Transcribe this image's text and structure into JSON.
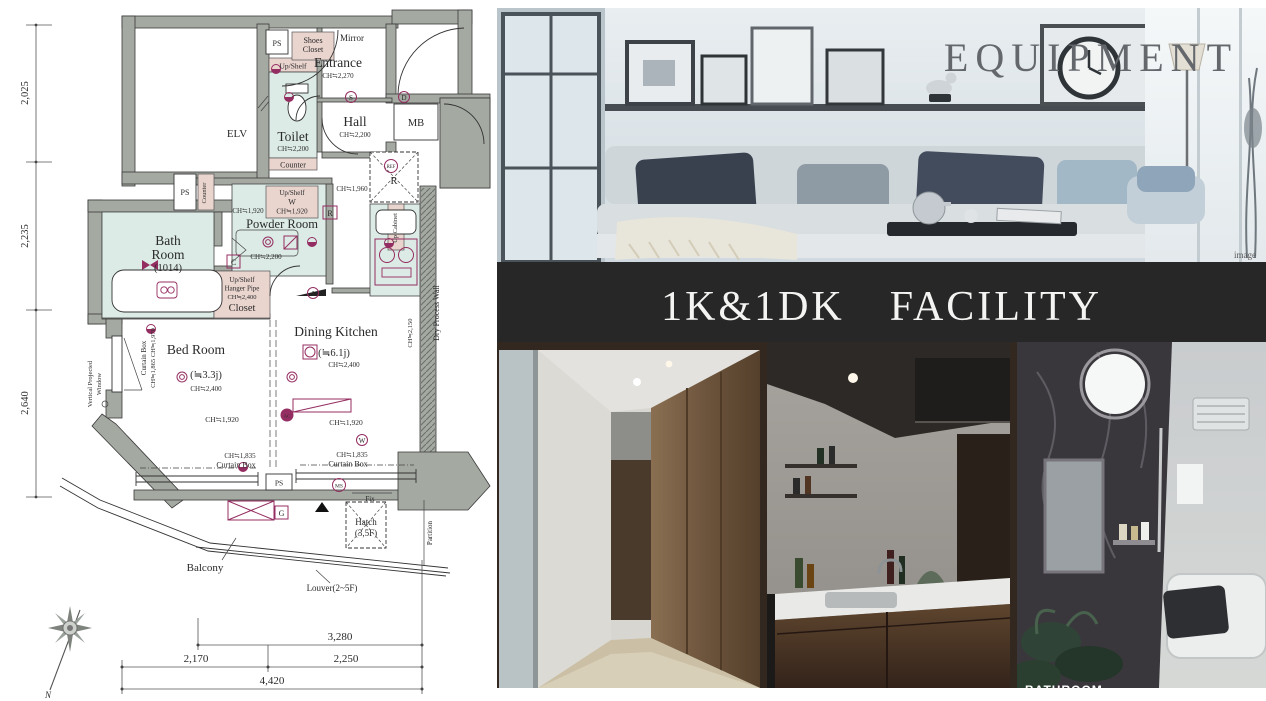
{
  "palette": {
    "banner_bg": "#272727",
    "plan_accent": "#942d61",
    "wet_room": "#dcebe5",
    "storage_pink": "#e9d4ce",
    "wall_gray": "#a4a9a2"
  },
  "hero": {
    "title": "EQUIPMENT",
    "caption": "image"
  },
  "banner": {
    "title": "1K&1DK　FACILITY"
  },
  "gallery": {
    "bathroom_caption": "BATHROOM"
  },
  "floorplan": {
    "dims": {
      "left": [
        "2,025",
        "2,235",
        "2,640"
      ],
      "b1": "3,280",
      "b2a": "2,170",
      "b2b": "2,250",
      "b3": "4,420",
      "north": "N"
    },
    "labels": {
      "elv": "ELV",
      "ps": "PS",
      "mirror": "Mirror",
      "shoes1": "Shoes",
      "shoes2": "Closet",
      "entrance": "Entrance",
      "entrance_ch": "CH≒2,270",
      "up_shelf": "Up/Shelf",
      "toilet": "Toilet",
      "ch2200": "CH≒2,200",
      "hall": "Hall",
      "mb": "MB",
      "counter": "Counter",
      "ch1960": "CH≒1,960",
      "ref": "REF",
      "r": "R",
      "up_cabinet": "Up Cabinet",
      "w": "W",
      "ch1920": "CH≒1,920",
      "powder": "Powder Room",
      "c": "C",
      "bath1": "Bath",
      "bath2": "Room",
      "bath_size": "(1014)",
      "hanger": "Hanger Pipe",
      "ch2400": "CH≒2,400",
      "closet": "Closet",
      "bed": "Bed Room",
      "bed_size": "(≒3.3j)",
      "curtain": "Curtain Box",
      "curtain_ch": "CH≒1,865  CH≒1,970",
      "dk": "Dining Kitchen",
      "dk_size": "(≒6.1j)",
      "ch2150": "CH≒2,150",
      "dry_wall": "Dry Process Wall",
      "vpw1": "Vertical Projected",
      "vpw2": "Window",
      "ch1835": "CH≒1,835",
      "ms": "MS",
      "fix": "Fix",
      "g": "G",
      "ac": "AC",
      "hatch": "Hatch",
      "hatch_f": "(3,5F)",
      "partition": "Partition",
      "balcony": "Balcony",
      "louver": "Louver(2~5F)"
    }
  }
}
